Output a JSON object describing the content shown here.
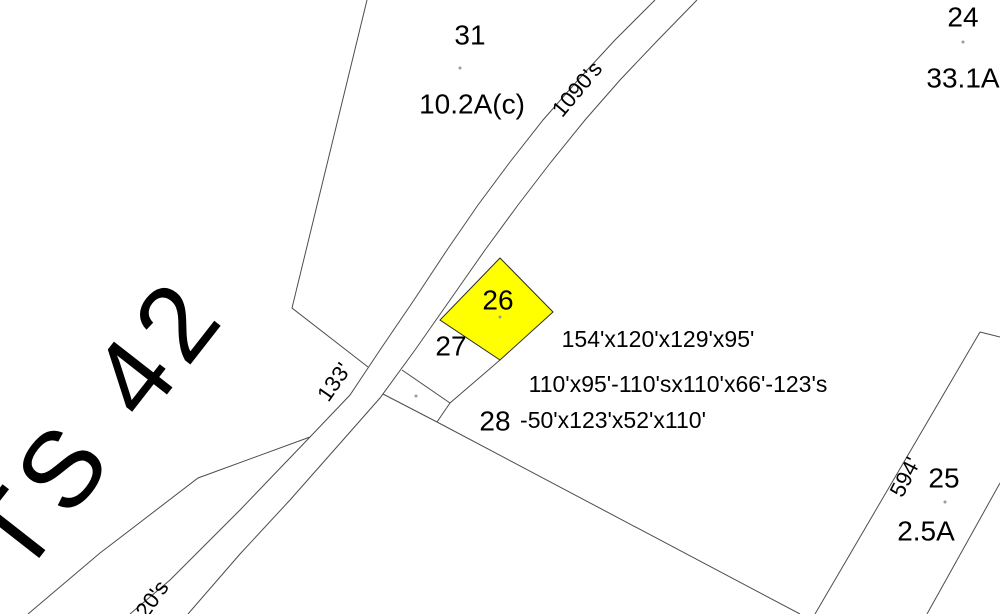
{
  "map_labels": {
    "big_area": "TS 42",
    "parcel_31": {
      "id": "31",
      "area": "10.2A(c)"
    },
    "parcel_24": {
      "id": "24",
      "area": "33.1A"
    },
    "parcel_26": {
      "id": "26",
      "dimensions": "154'x120'x129'x95'"
    },
    "parcel_27": {
      "id": "27",
      "dimensions": "110'x95'-110'sx110'x66'-123's"
    },
    "parcel_28": {
      "id": "28",
      "dimensions": "-50'x123'x52'x110'"
    },
    "parcel_25": {
      "id": "25",
      "area": "2.5A",
      "frontage": "594'"
    },
    "road_frontages": {
      "f1090": "1090's",
      "f133": "133'",
      "f20s": "20's"
    }
  },
  "colors": {
    "background": "#ffffff",
    "boundary_line": "#4d4d4d",
    "text": "#000000",
    "highlight_fill": "#ffff00"
  }
}
